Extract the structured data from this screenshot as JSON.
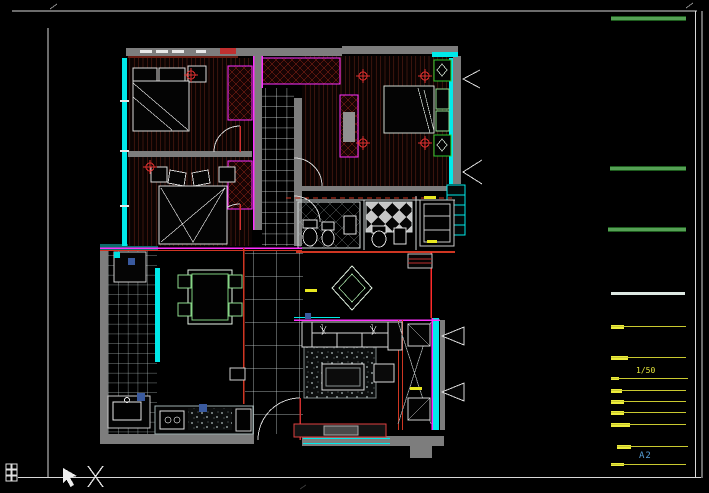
{
  "canvas": {
    "width": 709,
    "height": 493,
    "background": "#000000",
    "kind": "cad-floor-plan-view"
  },
  "palette": {
    "frame": "#d8d8d8",
    "wall_gray": "#7d7d7d",
    "wall_cyan": "#00eaea",
    "teal": "#0d6b6b",
    "magenta": "#ff2fff",
    "red": "#cf3622",
    "wood_line": "#87301f",
    "tile_line": "#c9d2d2",
    "furniture_white": "#d8d8d8",
    "furniture_green": "#37c837",
    "light_symbol_red": "#e03030",
    "legend_green": "#55a055",
    "legend_yellow": "#ecec3a",
    "label_blue": "#58a0d8",
    "accent_blue": "#3a5a9f"
  },
  "sidebar": {
    "scale_label": "1/50",
    "sheet_label": "A2",
    "green_bars": [
      {
        "x": 611,
        "y": 16,
        "w": 75,
        "h": 5
      },
      {
        "x": 610,
        "y": 166,
        "w": 76,
        "h": 5
      },
      {
        "x": 608,
        "y": 227,
        "w": 78,
        "h": 5
      }
    ],
    "white_line": {
      "x": 611,
      "y": 292,
      "w": 74,
      "h": 3
    },
    "legend_rows": [
      {
        "y": 325,
        "bar_x": 611,
        "bar_w": 13,
        "bar_h": 4,
        "line_x1": 611,
        "line_x2": 686
      },
      {
        "y": 356,
        "bar_x": 611,
        "bar_w": 17,
        "bar_h": 4,
        "line_x1": 611,
        "line_x2": 686
      },
      {
        "y": 377,
        "bar_x": 611,
        "bar_w": 8,
        "bar_h": 3,
        "line_x1": 611,
        "line_x2": 688
      },
      {
        "y": 389,
        "bar_x": 611,
        "bar_w": 11,
        "bar_h": 4,
        "line_x1": 611,
        "line_x2": 686
      },
      {
        "y": 400,
        "bar_x": 611,
        "bar_w": 13,
        "bar_h": 4,
        "line_x1": 611,
        "line_x2": 686
      },
      {
        "y": 411,
        "bar_x": 611,
        "bar_w": 13,
        "bar_h": 4,
        "line_x1": 611,
        "line_x2": 686
      },
      {
        "y": 423,
        "bar_x": 611,
        "bar_w": 19,
        "bar_h": 4,
        "line_x1": 611,
        "line_x2": 686
      },
      {
        "y": 445,
        "bar_x": 617,
        "bar_w": 14,
        "bar_h": 4,
        "line_x1": 617,
        "line_x2": 688
      },
      {
        "y": 463,
        "bar_x": 611,
        "bar_w": 13,
        "bar_h": 3,
        "line_x1": 611,
        "line_x2": 686
      }
    ]
  },
  "corner_icons": [
    "viewport-grid-icon",
    "cursor-arrow-icon",
    "x-marker-icon"
  ]
}
